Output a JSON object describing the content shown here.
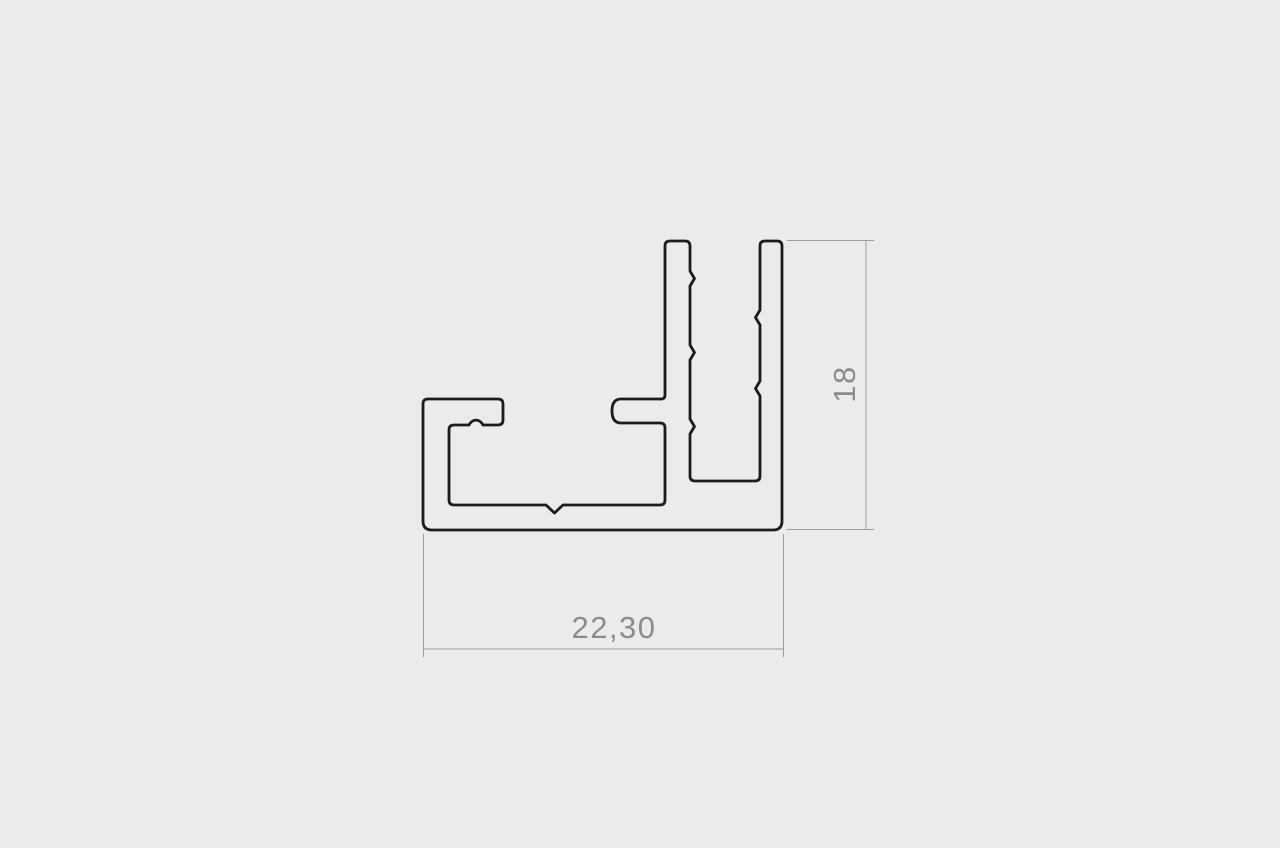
{
  "drawing": {
    "title": "aluminum-profile-cross-section",
    "dimensions": {
      "width_label": "22,30",
      "height_label": "18"
    },
    "colors": {
      "background": "#ebebeb",
      "outline": "#1c1c1c",
      "dimension_lines": "#9c9c9c",
      "dimension_text": "#8c8c8c"
    }
  }
}
